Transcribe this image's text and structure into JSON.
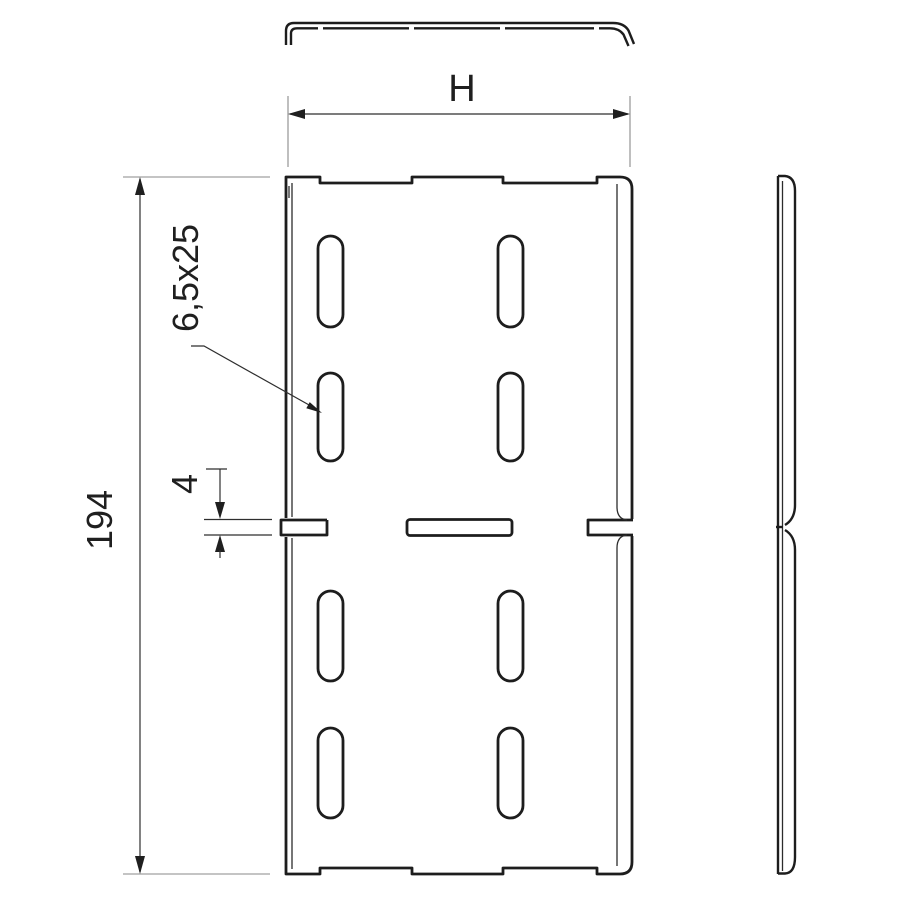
{
  "drawing": {
    "type": "technical-drawing",
    "subject": "perforated divider plate, three views with dimensions",
    "colors": {
      "background": "#ffffff",
      "outline": "#1d1d1d",
      "dimension_line": "#2e2e2e",
      "extension_line": "#8a8a8a",
      "text": "#1f1f1f"
    }
  },
  "views": {
    "top_profile": {
      "name": "top profile view (strip with bent ends)"
    },
    "front": {
      "name": "front view with 8 oblong slots, edge notches and mid slits"
    },
    "side_profile": {
      "name": "right side profile view"
    }
  },
  "dimensions": {
    "width": {
      "label": "H"
    },
    "height": {
      "label": "194"
    },
    "slot": {
      "label": "6,5x25"
    },
    "gap": {
      "label": "4"
    }
  }
}
